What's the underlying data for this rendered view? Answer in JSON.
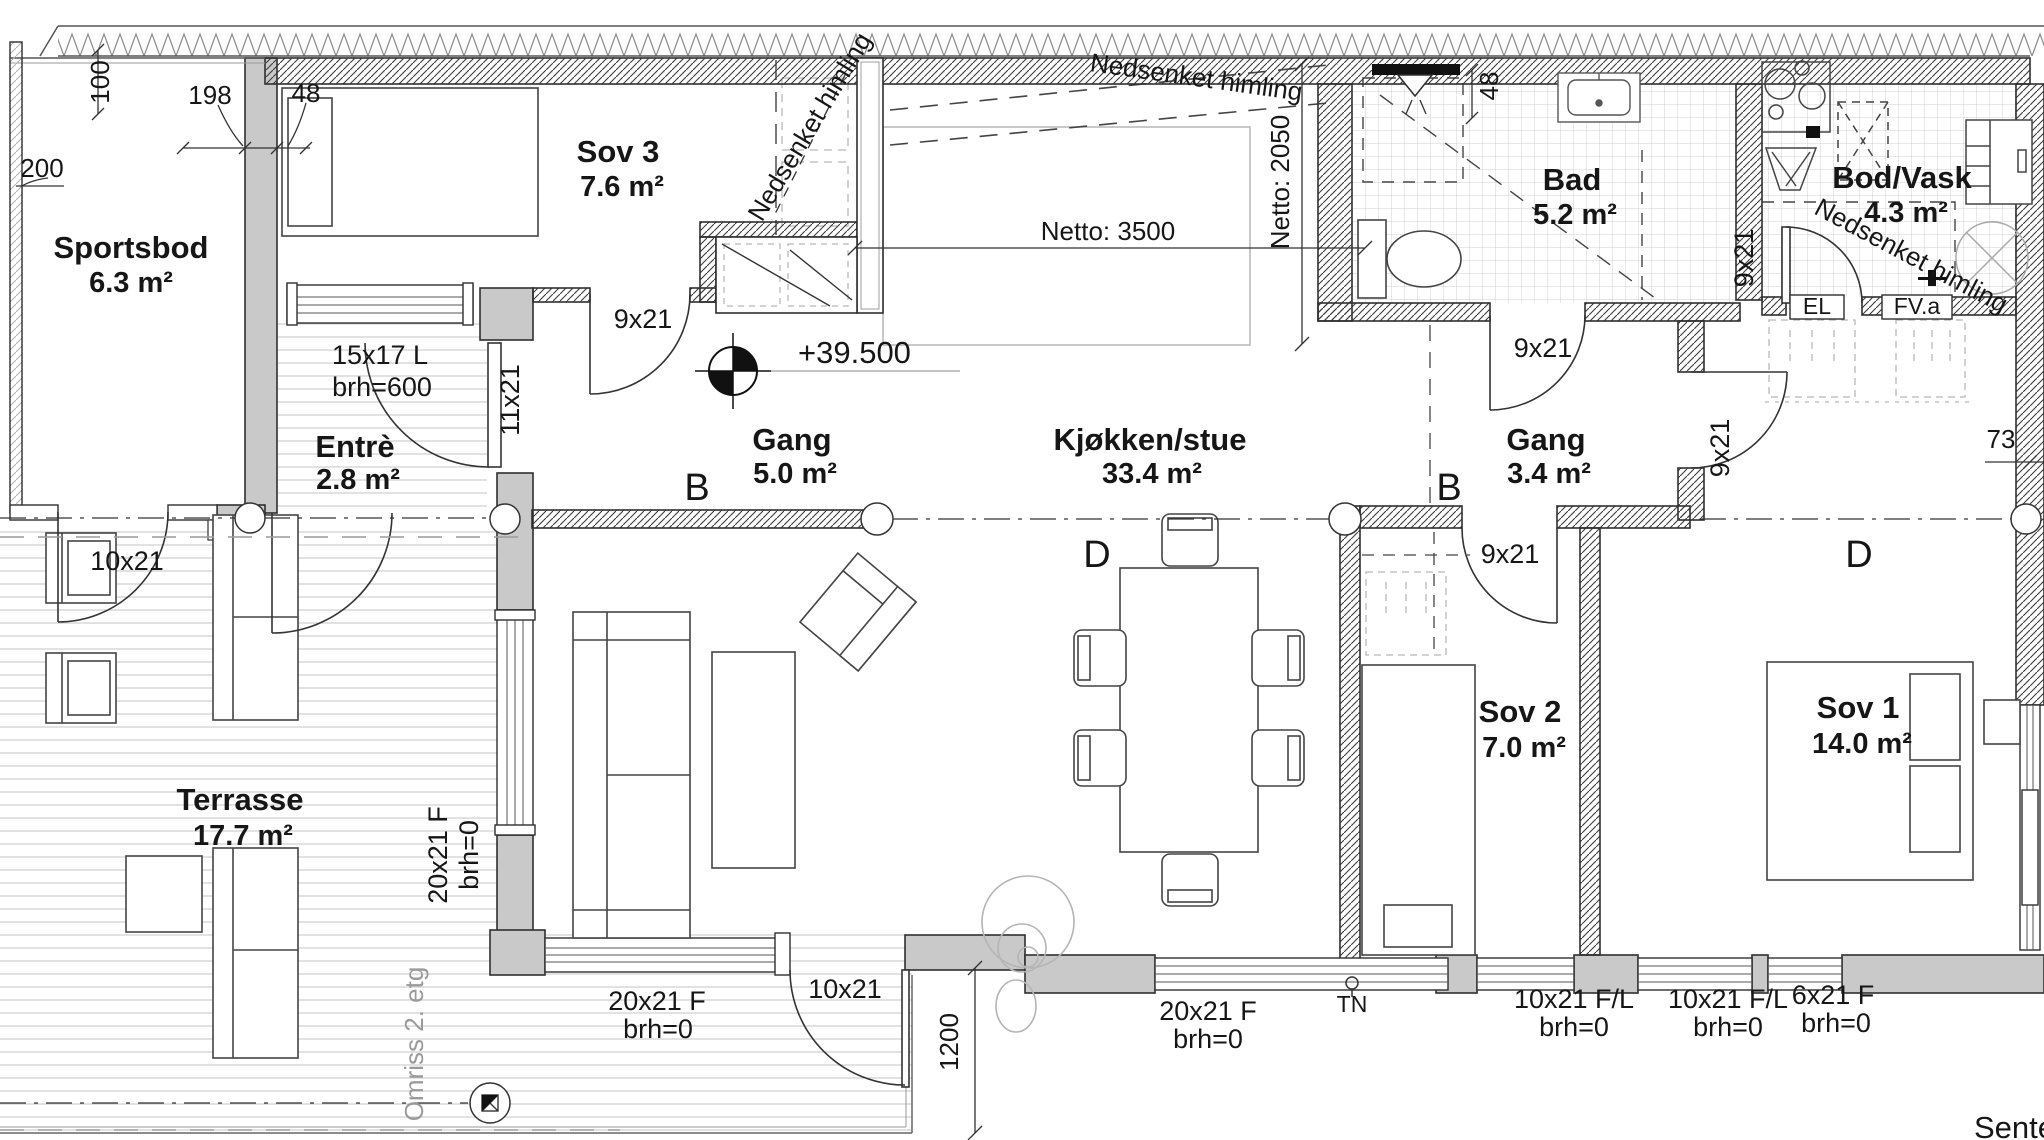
{
  "plan": {
    "rooms": {
      "sportsbod": {
        "name": "Sportsbod",
        "area": "6.3 m²"
      },
      "sov3": {
        "name": "Sov 3",
        "area": "7.6 m²"
      },
      "entre": {
        "name": "Entrè",
        "area": "2.8 m²"
      },
      "gang": {
        "name": "Gang",
        "area": "5.0 m²"
      },
      "kjokken_stue": {
        "name": "Kjøkken/stue",
        "area": "33.4 m²"
      },
      "bad": {
        "name": "Bad",
        "area": "5.2 m²"
      },
      "bod_vask": {
        "name": "Bod/Vask",
        "area": "4.3 m²"
      },
      "gang2": {
        "name": "Gang",
        "area": "3.4 m²"
      },
      "sov2": {
        "name": "Sov 2",
        "area": "7.0 m²"
      },
      "sov1": {
        "name": "Sov 1",
        "area": "14.0 m²"
      },
      "terrasse": {
        "name": "Terrasse",
        "area": "17.7 m²"
      }
    },
    "openings": {
      "door_sov3": {
        "label": "9x21"
      },
      "door_bad": {
        "label": "9x21"
      },
      "door_sov2": {
        "label": "9x21"
      },
      "door_sov1": {
        "label": "9x21"
      },
      "door_bodvask": {
        "label": "9x21"
      },
      "door_entre_inner": {
        "label": "11x21"
      },
      "door_sportsbod": {
        "label": "10x21"
      },
      "door_terrasse": {
        "label": "10x21"
      },
      "window_entre": {
        "label": "15x17 L",
        "sill": "brh=600"
      },
      "window_vest": {
        "label": "20x21 F",
        "sill": "brh=0"
      },
      "window_stue_sor": {
        "label": "20x21 F",
        "sill": "brh=0"
      },
      "window_stue_sor2": {
        "label": "20x21 F",
        "sill": "brh=0"
      },
      "window_sov2": {
        "label": "10x21 F/L",
        "sill": "brh=0"
      },
      "window_sov1_a": {
        "label": "10x21 F/L",
        "sill": "brh=0"
      },
      "window_sov1_b": {
        "label": "6x21 F",
        "sill": "brh=0"
      }
    },
    "dimensions": {
      "left_100": "100",
      "left_198": "198",
      "left_48": "48",
      "left_200": "200",
      "bad_48": "48",
      "netto_bredde": "Netto: 3500",
      "netto_dybde": "Netto: 2050",
      "terrasse_1200": "1200",
      "sov1_73": "73",
      "hoyde": "+39.500"
    },
    "annotations": {
      "nedsenket_himling": "Nedsenket himling",
      "omriss": "Omriss 2. etg",
      "el": "EL",
      "fva": "FV.a",
      "tn": "TN",
      "section_b": "B",
      "section_d": "D",
      "senter": "Senter"
    }
  }
}
